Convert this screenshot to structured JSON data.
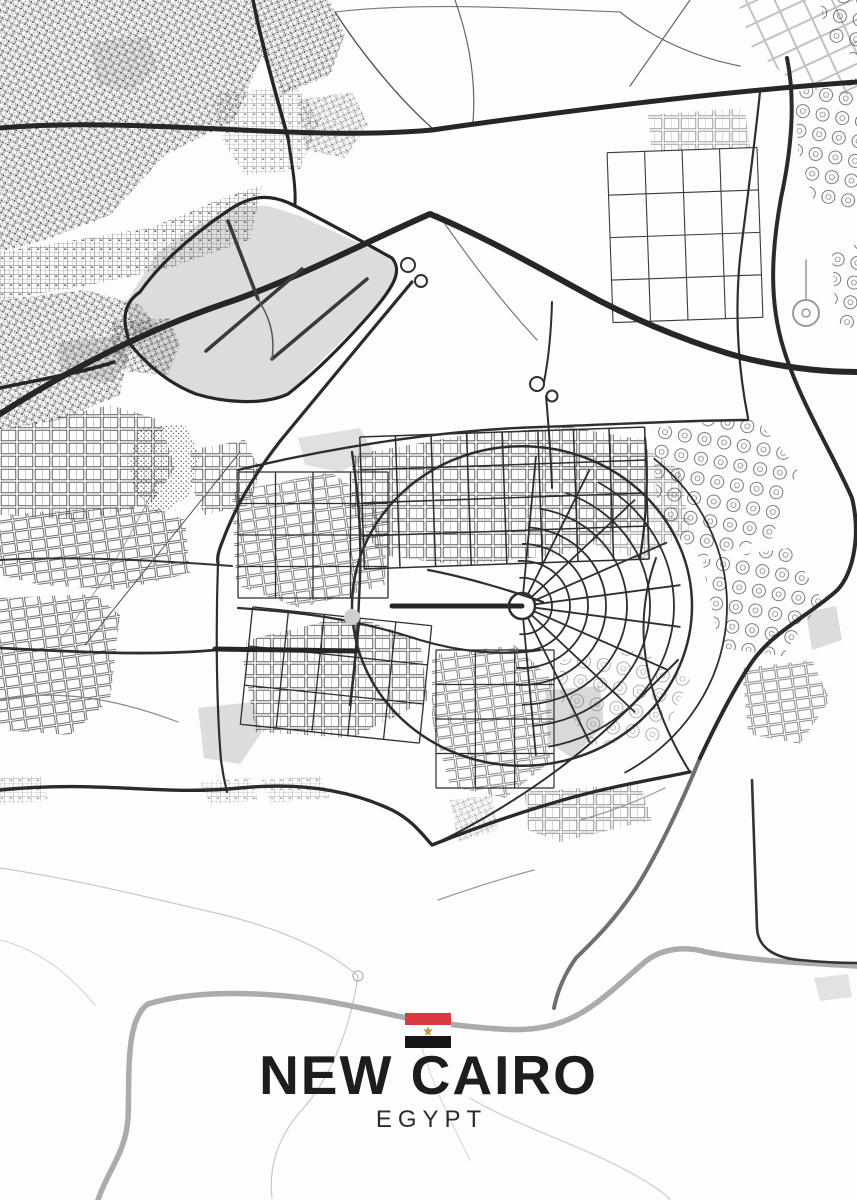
{
  "poster": {
    "title": "NEW CAIRO",
    "subtitle": "EGYPT",
    "flag": {
      "red": "#d93a40",
      "white": "#ffffff",
      "black": "#16161b",
      "gold": "#c19a3d"
    },
    "colors": {
      "bg": "#fdfdfd",
      "ink": "#1d1d1f",
      "subtitle_ink": "#2c2c2c",
      "road_major": "#262626",
      "road_medium": "#2e2e2e",
      "road_minor": "#6f6f6f",
      "highway_gray": "#ababab",
      "area_gray": "#dcdcdc"
    }
  },
  "map": {
    "viewBox": "0 0 857 1200",
    "areas": [
      {
        "n": "airport-apron",
        "c": "#dcdcdc",
        "d": "M126 302 L158 252 L196 226 L238 206 L268 206 L300 216 L352 240 L392 258 L398 276 L372 312 L330 352 L288 394 L246 404 L196 394 L156 372 L134 344 Z"
      },
      {
        "n": "gray-area-west-of-airport",
        "c": "#dcdcdc",
        "d": "M58 342 L118 336 L128 362 L112 382 L62 378 Z"
      },
      {
        "n": "park-old-cairo",
        "c": "#e9e9e9",
        "d": "M92 42 L148 36 L158 66 L132 92 L96 84 Z"
      },
      {
        "n": "gray-area-nw-ncairo",
        "c": "#e0e0e0",
        "d": "M298 438 L360 428 L375 455 L340 472 L305 465 Z"
      },
      {
        "n": "gray-area-sw-ncairo",
        "c": "#dcdcdc",
        "d": "M198 708 L252 702 L262 732 L240 764 L204 758 Z"
      },
      {
        "n": "gray-area-south-ncairo",
        "c": "#d9d9d9",
        "d": "M545 690 L600 686 L604 726 L572 758 L548 742 Z"
      },
      {
        "n": "gray-wedge-east",
        "c": "#dcdcdc",
        "d": "M806 612 L836 606 L842 640 L812 650 Z"
      },
      {
        "n": "gray-patch-southeast",
        "c": "#e2e2e2",
        "d": "M814 978 L848 974 L852 997 L820 1001 Z"
      }
    ],
    "textures": [
      {
        "n": "old-cairo-dense-1",
        "p": "dense-a",
        "d": "M0 0 L250 0 L262 55 L235 120 L165 155 L110 215 L45 240 L0 252 Z"
      },
      {
        "n": "old-cairo-dense-2",
        "p": "dense-b",
        "d": "M250 0 L330 0 L345 35 L330 75 L282 95 L262 55 Z"
      },
      {
        "n": "old-cairo-dense-3",
        "p": "dense-c",
        "d": "M0 252 L150 228 L228 196 L262 185 L250 240 L170 268 L90 285 L0 300 Z"
      },
      {
        "n": "old-cairo-dense-4",
        "p": "dense-a",
        "d": "M0 300 L85 290 L140 305 L160 330 L130 345 L120 395 L60 420 L0 430 Z"
      },
      {
        "n": "nasr-city-blocks-1",
        "p": "blocks-a",
        "d": "M0 430 L110 405 L160 420 L175 468 L150 505 L80 520 L0 515 Z"
      },
      {
        "n": "nasr-city-blocks-2",
        "p": "blocks-b",
        "d": "M0 515 L150 505 L185 520 L190 573 L120 590 L40 585 L0 575 Z"
      },
      {
        "n": "stipple-grove",
        "p": "stipple",
        "d": "M140 428 L185 424 L200 455 L190 495 L160 515 L135 495 L128 460 Z"
      },
      {
        "n": "blocks-east-of-grove",
        "p": "blocks-a",
        "d": "M190 450 L245 440 L260 470 L250 505 L205 515 L192 488 Z"
      },
      {
        "n": "left-edge-blocks",
        "p": "blocks-b",
        "d": "M0 598 L95 594 L120 615 L110 700 L70 735 L0 730 Z"
      },
      {
        "n": "sheraton-compound",
        "p": "dense-b",
        "d": "M112 322 L170 318 L180 345 L168 375 L128 372 L112 350 Z"
      },
      {
        "n": "north-settlement-1",
        "p": "dense-c",
        "op": 0.75,
        "d": "M215 95 L295 85 L320 120 L300 170 L245 175 L222 140 Z"
      },
      {
        "n": "north-settlement-2",
        "p": "dense-b",
        "op": 0.7,
        "d": "M298 100 L352 92 L368 125 L345 158 L305 150 Z"
      },
      {
        "n": "farm-fields-ne",
        "p": "fields",
        "d": "M737 0 L857 0 L857 96 L800 88 L752 48 Z"
      },
      {
        "n": "industrial-north",
        "p": "blocks-a",
        "op": 0.6,
        "d": "M648 115 L745 108 L750 148 L652 152 Z"
      },
      {
        "n": "suburb-curvy-ne-1",
        "p": "curvy",
        "d": "M795 92 L857 78 L857 212 L815 205 L798 150 Z"
      },
      {
        "n": "suburb-curvy-ne-2",
        "p": "curvy",
        "d": "M832 252 L857 244 L857 330 L836 322 Z"
      },
      {
        "n": "suburb-curvy-corner",
        "p": "curvy",
        "d": "M820 0 L857 0 L857 58 L826 40 Z"
      },
      {
        "n": "ncairo-north-grid",
        "p": "blocks-a",
        "d": "M352 455 L470 434 L570 427 L644 440 L646 520 L560 555 L460 565 L380 555 L352 510 Z"
      },
      {
        "n": "ncairo-west-grid",
        "p": "blocks-b",
        "op": 0.9,
        "d": "M232 492 L330 472 L388 510 L385 585 L300 608 L236 585 Z"
      },
      {
        "n": "ncairo-sw-cluster",
        "p": "blocks-a",
        "d": "M240 642 L352 615 L420 640 L428 700 L352 738 L256 732 Z"
      },
      {
        "n": "ncairo-south-tongue",
        "p": "blocks-b",
        "op": 0.85,
        "d": "M432 655 L515 645 L552 680 L550 762 L505 798 L450 786 L432 720 Z"
      },
      {
        "n": "ncairo-ne-sector",
        "p": "blocks-a",
        "op": 0.65,
        "d": "M560 455 L640 445 L680 470 L690 530 L640 560 L580 540 L560 500 Z"
      },
      {
        "n": "ncairo-se-sector",
        "p": "curvy",
        "op": 0.6,
        "d": "M560 660 L640 650 L690 680 L660 740 L590 745 L560 700 Z"
      },
      {
        "n": "east-curvy-1",
        "p": "curvy",
        "d": "M652 428 L755 418 L798 468 L772 538 L700 558 L658 518 Z"
      },
      {
        "n": "east-curvy-2",
        "p": "curvy",
        "d": "M702 560 L790 548 L822 600 L782 656 L720 648 Z"
      },
      {
        "n": "east-blocks",
        "p": "blocks-b",
        "op": 0.8,
        "d": "M742 668 L812 660 L830 700 L800 744 L748 734 Z"
      },
      {
        "n": "south-compound-1",
        "p": "blocks-a",
        "op": 0.7,
        "d": "M525 792 L640 784 L652 820 L560 842 L528 830 Z"
      },
      {
        "n": "south-compound-2",
        "p": "dense-b",
        "op": 0.5,
        "d": "M450 800 L492 795 L498 830 L458 842 Z"
      },
      {
        "n": "south-strip-1",
        "p": "dense-c",
        "op": 0.6,
        "d": "M200 782 L250 778 L258 800 L210 805 Z"
      },
      {
        "n": "south-strip-2",
        "p": "dense-c",
        "op": 0.6,
        "d": "M262 780 L320 776 L330 798 L270 803 Z"
      },
      {
        "n": "south-strip-3",
        "p": "dense-c",
        "op": 0.6,
        "d": "M0 778 L40 775 L48 800 L0 805 Z"
      }
    ],
    "grids": [
      {
        "n": "arterial-grid-north",
        "x": 362,
        "y": 432,
        "w": 285,
        "h": 132,
        "cols": 8,
        "rows": 4,
        "angle": -2,
        "lw": 1.5,
        "c": "#2e2e2e"
      },
      {
        "n": "arterial-grid-west",
        "x": 238,
        "y": 472,
        "w": 150,
        "h": 126,
        "cols": 4,
        "rows": 4,
        "angle": 0,
        "lw": 1.3,
        "c": "#2e2e2e"
      },
      {
        "n": "arterial-grid-sw",
        "x": 246,
        "y": 616,
        "w": 180,
        "h": 118,
        "cols": 5,
        "rows": 3,
        "angle": 6,
        "lw": 1.3,
        "c": "#2e2e2e"
      },
      {
        "n": "arterial-grid-south",
        "x": 436,
        "y": 650,
        "w": 118,
        "h": 138,
        "cols": 3,
        "rows": 4,
        "angle": 0,
        "lw": 1.2,
        "c": "#2e2e2e"
      },
      {
        "n": "parcel-grid-northeast",
        "x": 610,
        "y": 150,
        "w": 150,
        "h": 170,
        "cols": 4,
        "rows": 4,
        "angle": -2,
        "lw": 1.1,
        "c": "#3a3a3a"
      }
    ],
    "radial": {
      "cx": 522,
      "cy": 606,
      "ry": 0.94,
      "w": 1.8,
      "c": "#2e2e2e",
      "r0": 13,
      "r1": 160,
      "rings": [
        {
          "r": 30,
          "a0": -95,
          "a1": 95
        },
        {
          "r": 48,
          "a0": -95,
          "a1": 95
        },
        {
          "r": 66,
          "a0": -90,
          "a1": 95
        },
        {
          "r": 84,
          "a0": -85,
          "a1": 95
        },
        {
          "r": 105,
          "a0": -80,
          "a1": 90
        },
        {
          "r": 128,
          "a0": -70,
          "a1": 85
        },
        {
          "r": 152,
          "a0": -60,
          "a1": 80
        },
        {
          "r": 170,
          "full": true
        },
        {
          "r": 205,
          "a0": -50,
          "a1": 60
        }
      ],
      "spokes": [
        -85,
        -65,
        -45,
        -25,
        -8,
        8,
        25,
        45,
        65,
        85
      ]
    },
    "roads": [
      {
        "n": "wadi-1",
        "w": 1.2,
        "c": "#c8c8c8",
        "d": "M0 868 C 80 880 150 898 220 914 C 285 930 330 952 358 976"
      },
      {
        "n": "wadi-2",
        "w": 1.2,
        "c": "#c8c8c8",
        "d": "M358 976 C 350 1030 330 1080 300 1112 C 280 1135 268 1165 272 1198"
      },
      {
        "n": "wadi-3",
        "w": 1.2,
        "c": "#cccccc",
        "d": "M470 1098 C 520 1128 590 1148 640 1178 C 660 1190 668 1196 670 1200"
      },
      {
        "n": "wadi-4",
        "w": 1,
        "c": "#d0d0d0",
        "d": "M0 940 C 40 950 70 975 95 1005"
      },
      {
        "n": "wadi-5",
        "w": 1,
        "c": "#d5d5d5",
        "d": "M420 1040 C 430 1080 450 1120 470 1160"
      },
      {
        "n": "trail-straight",
        "w": 1,
        "c": "#9a9a9a",
        "d": "M60 640 C 90 600 120 560 158 480"
      },
      {
        "n": "regional-ring-road",
        "w": 5.5,
        "c": "#ababab",
        "d": "M98 1200 C 108 1170 126 1152 128 1118 C 130 1083 124 1020 148 1004 C 190 991 252 991 312 999 C 372 1008 406 1020 436 1023 C 480 1027 522 1035 556 1024 C 590 1014 614 988 646 961 C 663 948 686 946 706 952 C 746 960 800 963 857 966"
      },
      {
        "n": "ring-road-south-link",
        "w": 4,
        "c": "#6f6f6f",
        "d": "M700 758 C 685 795 660 850 636 888 C 612 924 590 944 576 958 C 566 972 558 988 554 1008"
      },
      {
        "n": "road-top-1",
        "w": 1.1,
        "c": "#777777",
        "d": "M335 12 C 420 2 520 8 620 12"
      },
      {
        "n": "road-top-2",
        "w": 1.4,
        "c": "#555555",
        "d": "M335 12 C 358 48 395 95 432 128"
      },
      {
        "n": "road-top-3",
        "w": 1.2,
        "c": "#666666",
        "d": "M455 0 C 470 42 476 84 473 122"
      },
      {
        "n": "road-top-4",
        "w": 1.2,
        "c": "#666666",
        "d": "M620 12 C 655 40 698 58 740 66"
      },
      {
        "n": "road-top-5",
        "w": 1.2,
        "c": "#666666",
        "d": "M690 0 L630 86"
      },
      {
        "n": "road-mid-thin",
        "w": 1.2,
        "c": "#777777",
        "d": "M438 214 C 470 260 500 300 537 340"
      },
      {
        "n": "road-left-1",
        "w": 1.2,
        "c": "#888888",
        "d": "M0 700 C 60 688 120 700 178 722"
      },
      {
        "n": "road-left-2",
        "w": 2,
        "c": "#333333",
        "d": "M0 560 C 75 556 150 560 232 566"
      },
      {
        "n": "road-left-3",
        "w": 2.8,
        "c": "#2e2e2e",
        "d": "M0 648 C 80 652 150 656 215 650"
      },
      {
        "n": "railway-diagonal",
        "w": 1,
        "c": "#555555",
        "d": "M240 452 L85 645"
      },
      {
        "n": "ncairo-north-arc",
        "w": 2.4,
        "c": "#2e2e2e",
        "d": "M238 470 C 330 448 440 430 540 427 C 620 424 700 420 748 420"
      },
      {
        "n": "ncairo-west-vertical",
        "w": 2.4,
        "c": "#2e2e2e",
        "d": "M352 452 C 360 505 362 548 359 600 C 357 645 354 672 350 705"
      },
      {
        "n": "ncairo-east-vertical",
        "w": 2.2,
        "c": "#2e2e2e",
        "d": "M645 438 C 649 478 646 520 640 558"
      },
      {
        "n": "ncairo-hub-connector",
        "w": 2.2,
        "c": "#2e2e2e",
        "d": "M428 570 C 466 577 515 592 543 602"
      },
      {
        "n": "ncairo-mid-arterial",
        "w": 2.2,
        "c": "#2e2e2e",
        "d": "M238 608 C 300 612 352 618 420 640 C 460 652 502 656 540 650"
      },
      {
        "n": "ncairo-se-arterial",
        "w": 2,
        "c": "#2e2e2e",
        "d": "M432 845 C 470 828 520 798 560 768 C 602 736 640 698 678 660"
      },
      {
        "n": "feeder-north-upper",
        "w": 2,
        "c": "#2e2e2e",
        "d": "M552 302 C 551 336 548 362 544 382"
      },
      {
        "n": "feeder-north-lower",
        "w": 2,
        "c": "#2e2e2e",
        "d": "M546 396 C 549 430 551 458 552 488"
      },
      {
        "n": "ncairo-east-vertical-2",
        "w": 2,
        "c": "#2e2e2e",
        "d": "M656 558 C 641 600 640 640 650 680 C 658 710 671 742 690 772"
      },
      {
        "n": "east-ns-connector",
        "w": 2.2,
        "c": "#2e2e2e",
        "d": "M760 92 C 754 150 747 200 740 258 C 735 310 737 362 748 418"
      },
      {
        "n": "west-vertical",
        "w": 2.2,
        "c": "#2e2e2e",
        "d": "M218 562 C 216 620 216 700 221 760 C 223 776 225 784 227 792"
      },
      {
        "n": "airport-east-link",
        "w": 3.2,
        "c": "#2b2b2b",
        "d": "M412 282 C 372 330 322 390 281 440 C 256 472 236 505 223 540 C 218 552 217 558 218 563"
      },
      {
        "n": "south-road-1",
        "w": 1.2,
        "c": "#999999",
        "d": "M438 900 C 472 888 504 878 534 870"
      },
      {
        "n": "south-road-2",
        "w": 1.2,
        "c": "#999999",
        "d": "M580 820 C 610 812 640 800 665 788"
      },
      {
        "n": "airport-ring-road",
        "w": 3.2,
        "c": "#262626",
        "d": "M130 344 C 121 318 124 303 140 292 C 158 266 188 238 226 212 C 250 195 268 194 289 203 C 320 218 356 238 392 258 C 400 268 400 280 372 312 C 344 344 316 372 288 394 C 262 406 222 402 196 394 C 170 384 148 366 130 344 Z"
      },
      {
        "n": "highway-north",
        "w": 5,
        "c": "#262626",
        "d": "M0 128 C 140 116 300 142 432 130 C 600 106 742 90 857 82"
      },
      {
        "n": "road-north-vertical",
        "w": 3.6,
        "c": "#262626",
        "d": "M253 0 C 262 45 276 95 288 138"
      },
      {
        "n": "road-airport-north",
        "w": 3,
        "c": "#262626",
        "d": "M288 138 C 292 165 296 186 295 204"
      },
      {
        "n": "suez-desert-road",
        "w": 6,
        "c": "#262626",
        "d": "M0 414 C 90 356 168 322 235 300 C 302 276 370 240 430 214 C 492 240 546 272 598 300 C 648 326 700 346 744 358 C 786 368 822 372 857 372"
      },
      {
        "n": "left-diagonal",
        "w": 3.6,
        "c": "#262626",
        "d": "M0 388 C 48 378 84 372 114 362"
      },
      {
        "n": "ring-road-east",
        "w": 4,
        "c": "#2a2a2a",
        "d": "M787 58 C 796 102 791 152 781 198 C 772 248 768 300 784 350 C 800 402 832 452 852 498 C 862 540 851 580 834 593 C 806 617 772 633 752 662 C 734 688 716 724 700 758"
      },
      {
        "n": "south-vertical",
        "w": 2.6,
        "c": "#333333",
        "d": "M752 780 C 754 830 755 880 757 928 C 758 948 775 958 800 960 C 820 962 840 963 857 963"
      },
      {
        "n": "south-black-road",
        "w": 3.4,
        "c": "#2a2a2a",
        "d": "M0 790 C 100 780 160 796 240 788 C 300 782 350 790 392 810 C 412 820 422 834 432 845 C 470 830 520 812 570 798 C 610 787 640 782 690 772"
      },
      {
        "n": "central-axis",
        "w": 5,
        "c": "#262626",
        "d": "M392 606 L522 606"
      },
      {
        "n": "west-axis-bar",
        "w": 5,
        "c": "#262626",
        "d": "M215 649 L356 651"
      },
      {
        "n": "runway-1",
        "w": 3.5,
        "c": "#3a3a3a",
        "d": "M228 221 L258 299"
      },
      {
        "n": "runway-2",
        "w": 3.5,
        "c": "#3a3a3a",
        "d": "M302 269 L206 351"
      },
      {
        "n": "runway-3",
        "w": 3.5,
        "c": "#3a3a3a",
        "d": "M367 279 L272 359"
      },
      {
        "n": "taxiway",
        "w": 1.5,
        "c": "#555555",
        "d": "M258 299 C 266 312 276 330 272 359"
      },
      {
        "n": "balloon-stem",
        "w": 1.5,
        "c": "#999999",
        "d": "M806 260 L806 300"
      }
    ],
    "circles": [
      {
        "n": "pond",
        "cx": 352,
        "cy": 617,
        "r": 8,
        "f": "#cfcfcf"
      },
      {
        "n": "hub-circle",
        "cx": 522,
        "cy": 606,
        "r": 13,
        "w": 2.5,
        "c": "#2e2e2e"
      },
      {
        "n": "interchange-1",
        "cx": 408,
        "cy": 265,
        "r": 7,
        "w": 2,
        "c": "#2e2e2e"
      },
      {
        "n": "interchange-2",
        "cx": 421,
        "cy": 281,
        "r": 6,
        "w": 2,
        "c": "#2e2e2e"
      },
      {
        "n": "loop-1",
        "cx": 537,
        "cy": 384,
        "r": 7,
        "w": 2,
        "c": "#2e2e2e"
      },
      {
        "n": "loop-2",
        "cx": 552,
        "cy": 396,
        "r": 5.5,
        "w": 2,
        "c": "#2e2e2e"
      },
      {
        "n": "balloon-road",
        "cx": 806,
        "cy": 313,
        "r": 13,
        "w": 2,
        "c": "#999999"
      },
      {
        "n": "balloon-road-inner",
        "cx": 806,
        "cy": 313,
        "r": 4,
        "w": 1.5,
        "c": "#999999"
      },
      {
        "n": "roundabout-sw",
        "cx": 358,
        "cy": 976,
        "r": 5,
        "w": 1.5,
        "c": "#c0c0c0"
      }
    ]
  }
}
